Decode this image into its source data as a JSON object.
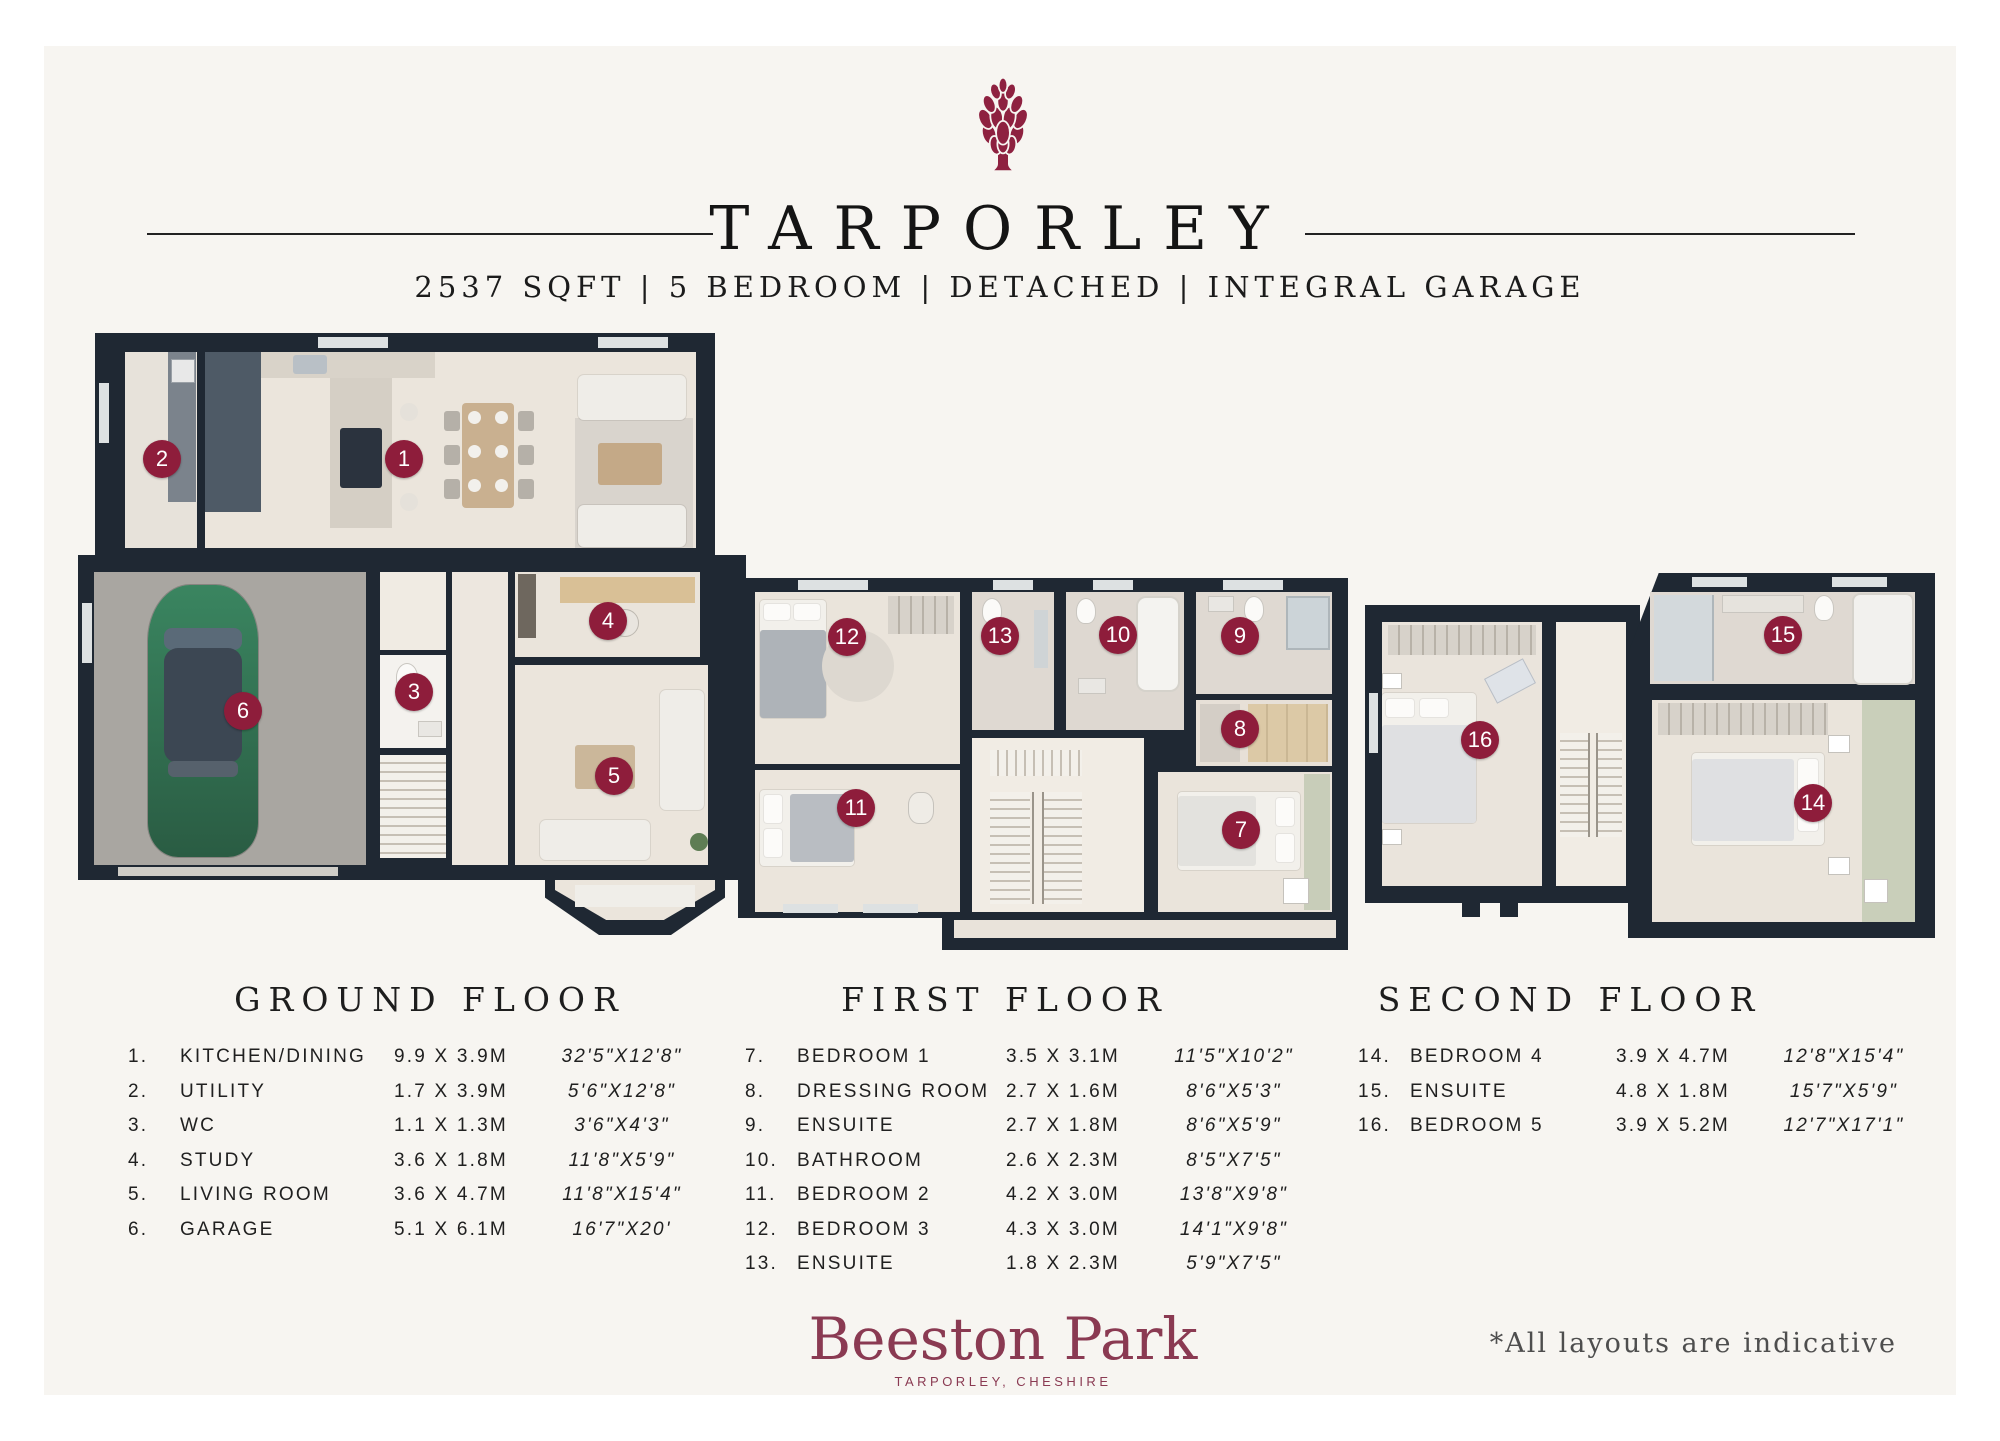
{
  "header": {
    "logo": "artichoke-logo-icon",
    "title": "TARPORLEY",
    "subtitle": "2537 SQFT | 5 BEDROOM | DETACHED | INTEGRAL GARAGE"
  },
  "colors": {
    "badge": "#8E1D3B",
    "wall": "#1F2833",
    "brand": "#8A3A52",
    "card_background": "#F7F5F1"
  },
  "badges": [
    "1",
    "2",
    "3",
    "4",
    "5",
    "6",
    "7",
    "8",
    "9",
    "10",
    "11",
    "12",
    "13",
    "14",
    "15",
    "16"
  ],
  "floors": [
    {
      "name": "GROUND FLOOR",
      "rooms": [
        {
          "num": "1.",
          "name": "KITCHEN/DINING",
          "metric": "9.9 X 3.9M",
          "imperial": "32'5\"X12'8\""
        },
        {
          "num": "2.",
          "name": "UTILITY",
          "metric": "1.7 X 3.9M",
          "imperial": "5'6\"X12'8\""
        },
        {
          "num": "3.",
          "name": "WC",
          "metric": "1.1 X 1.3M",
          "imperial": "3'6\"X4'3\""
        },
        {
          "num": "4.",
          "name": "STUDY",
          "metric": "3.6 X 1.8M",
          "imperial": "11'8\"X5'9\""
        },
        {
          "num": "5.",
          "name": "LIVING ROOM",
          "metric": "3.6 X 4.7M",
          "imperial": "11'8\"X15'4\""
        },
        {
          "num": "6.",
          "name": "GARAGE",
          "metric": "5.1 X 6.1M",
          "imperial": "16'7\"X20'"
        }
      ]
    },
    {
      "name": "FIRST FLOOR",
      "rooms": [
        {
          "num": "7.",
          "name": "BEDROOM 1",
          "metric": "3.5 X 3.1M",
          "imperial": "11'5\"X10'2\""
        },
        {
          "num": "8.",
          "name": "DRESSING ROOM",
          "metric": "2.7 X 1.6M",
          "imperial": "8'6\"X5'3\""
        },
        {
          "num": "9.",
          "name": "ENSUITE",
          "metric": "2.7 X 1.8M",
          "imperial": "8'6\"X5'9\""
        },
        {
          "num": "10.",
          "name": "BATHROOM",
          "metric": "2.6 X 2.3M",
          "imperial": "8'5\"X7'5\""
        },
        {
          "num": "11.",
          "name": "BEDROOM 2",
          "metric": "4.2 X 3.0M",
          "imperial": "13'8\"X9'8\""
        },
        {
          "num": "12.",
          "name": "BEDROOM 3",
          "metric": "4.3 X 3.0M",
          "imperial": "14'1\"X9'8\""
        },
        {
          "num": "13.",
          "name": "ENSUITE",
          "metric": "1.8 X 2.3M",
          "imperial": "5'9\"X7'5\""
        }
      ]
    },
    {
      "name": "SECOND FLOOR",
      "rooms": [
        {
          "num": "14.",
          "name": "BEDROOM 4",
          "metric": "3.9 X 4.7M",
          "imperial": "12'8\"X15'4\""
        },
        {
          "num": "15.",
          "name": "ENSUITE",
          "metric": "4.8 X 1.8M",
          "imperial": "15'7\"X5'9\""
        },
        {
          "num": "16.",
          "name": "BEDROOM 5",
          "metric": "3.9 X 5.2M",
          "imperial": "12'7\"X17'1\""
        }
      ]
    }
  ],
  "footer": {
    "brand": "Beeston Park",
    "brand_subtitle": "TARPORLEY, CHESHIRE",
    "disclaimer": "*All layouts are indicative"
  }
}
